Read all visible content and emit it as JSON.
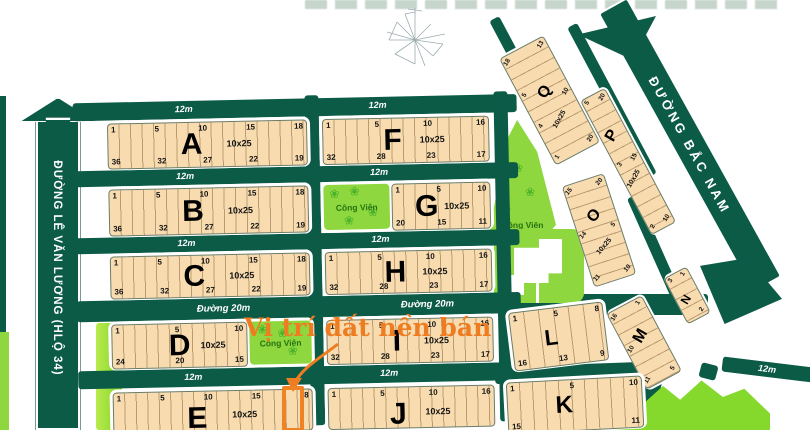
{
  "roads": {
    "le_van_luong": "ĐƯỜNG LÊ VĂN LƯƠNG (HLỘ 34)",
    "bac_nam": "ĐƯỜNG BẮC NAM",
    "duong_20m": "Đường 20m",
    "label_12m": "12m"
  },
  "annotation": {
    "text": "Vị trí đất nền bán"
  },
  "park_label": "Công Viên",
  "icons": {
    "flower": "❀"
  },
  "blocks": {
    "A": {
      "letter": "A",
      "size": "10x25",
      "top": [
        "1",
        "5",
        "10",
        "15",
        "18"
      ],
      "bottom": [
        "36",
        "32",
        "27",
        "22",
        "19"
      ]
    },
    "B": {
      "letter": "B",
      "size": "10x25",
      "top": [
        "1",
        "5",
        "10",
        "15",
        "18"
      ],
      "bottom": [
        "36",
        "32",
        "27",
        "22",
        "19"
      ]
    },
    "C": {
      "letter": "C",
      "size": "10x25",
      "top": [
        "1",
        "5",
        "10",
        "15",
        "18"
      ],
      "bottom": [
        "36",
        "32",
        "27",
        "22",
        "19"
      ]
    },
    "D": {
      "letter": "D",
      "size": "10x25",
      "top": [
        "1",
        "5",
        "10"
      ],
      "bottom": [
        "24",
        "20",
        "15"
      ]
    },
    "E": {
      "letter": "E",
      "size": "10x25",
      "top": [
        "1",
        "5",
        "10",
        "15",
        "18"
      ],
      "bottom": []
    },
    "F": {
      "letter": "F",
      "size": "10x25",
      "top": [
        "1",
        "5",
        "10",
        "16"
      ],
      "bottom": [
        "32",
        "28",
        "23",
        "17"
      ]
    },
    "G": {
      "letter": "G",
      "size": "10x25",
      "top": [
        "1",
        "5",
        "10"
      ],
      "bottom": [
        "20",
        "15",
        "11"
      ]
    },
    "H": {
      "letter": "H",
      "size": "10x25",
      "top": [
        "1",
        "5",
        "10",
        "16"
      ],
      "bottom": [
        "32",
        "28",
        "23",
        "17"
      ]
    },
    "I": {
      "letter": "I",
      "size": "10x25",
      "top": [
        "1",
        "5",
        "10",
        "16"
      ],
      "bottom": [
        "32",
        "28",
        "23",
        "17"
      ]
    },
    "J": {
      "letter": "J",
      "size": "10x25",
      "top": [
        "1",
        "5",
        "10",
        "16"
      ],
      "bottom": []
    },
    "K": {
      "letter": "K",
      "top": [
        "1",
        "5",
        "10"
      ],
      "bottom": [
        "15",
        "11"
      ]
    },
    "L": {
      "letter": "L",
      "top": [
        "1",
        "5",
        "8"
      ],
      "bottom": [
        "16",
        "13",
        "9"
      ]
    },
    "M": {
      "letter": "M",
      "top": [
        "1",
        "5"
      ],
      "bottom": [
        "16",
        "10",
        "11"
      ]
    },
    "N": {
      "letter": "N",
      "top": [
        "1",
        "2"
      ],
      "bottom": [
        "3"
      ]
    },
    "O": {
      "letter": "O",
      "size": "10x25",
      "top": [
        "20",
        "5",
        "10"
      ],
      "bottom": [
        "15",
        "14",
        "11"
      ]
    },
    "P": {
      "letter": "P",
      "size": "10x25",
      "top": [
        "20",
        "15",
        "10"
      ],
      "bottom": [
        "5",
        "3",
        "2"
      ]
    },
    "Q": {
      "letter": "Q",
      "size": "10x25",
      "top": [
        "13",
        "10",
        "20"
      ],
      "bottom": [
        "18",
        "5",
        "4",
        "1"
      ]
    }
  }
}
